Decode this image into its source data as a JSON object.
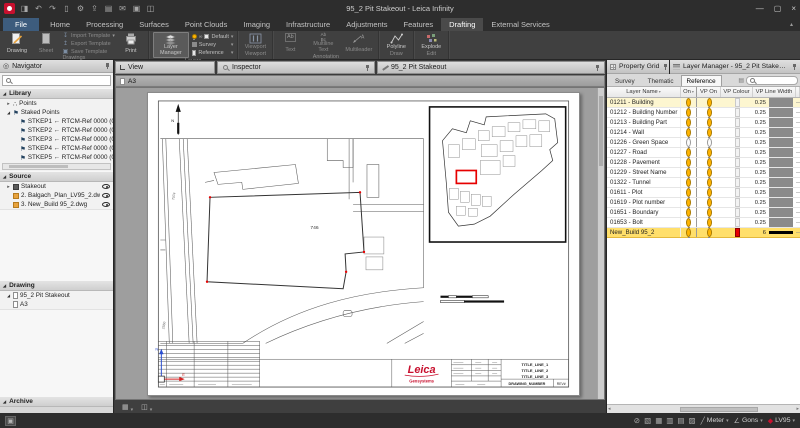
{
  "window": {
    "title": "95_2 Pit Stakeout - Leica Infinity",
    "qat": [
      {
        "name": "import-icon",
        "glyph": "◨"
      },
      {
        "name": "undo-icon",
        "glyph": "↶"
      },
      {
        "name": "redo-icon",
        "glyph": "↷"
      },
      {
        "name": "delete-icon",
        "glyph": "▯"
      },
      {
        "name": "settings-icon",
        "glyph": "⚙"
      },
      {
        "name": "export-icon",
        "glyph": "⇪"
      },
      {
        "name": "report-icon",
        "glyph": "▤"
      },
      {
        "name": "mail-icon",
        "glyph": "✉"
      },
      {
        "name": "print-icon",
        "glyph": "▣"
      },
      {
        "name": "window-icon",
        "glyph": "◫"
      }
    ],
    "controls": [
      {
        "name": "minimize-button",
        "glyph": "—"
      },
      {
        "name": "maximize-button",
        "glyph": "▢"
      },
      {
        "name": "close-button",
        "glyph": "×"
      }
    ]
  },
  "ribbon": {
    "tabs": [
      "File",
      "Home",
      "Processing",
      "Surfaces",
      "Point Clouds",
      "Imaging",
      "Infrastructure",
      "Adjustments",
      "Features",
      "Drafting",
      "External Services"
    ],
    "active_tab": "Drafting",
    "drawings": {
      "label": "Drawings",
      "drawing": "Drawing",
      "sheet": "Sheet",
      "import": "Import Template",
      "export": "Export Template",
      "save": "Save Template",
      "print": "Print"
    },
    "layers": {
      "label": "Layers",
      "layer_manager": "Layer Manager",
      "default": "Default",
      "survey": "Survey",
      "reference": "Reference"
    },
    "viewport": {
      "label": "Viewport",
      "viewport": "Viewport"
    },
    "annotation": {
      "label": "Annotation",
      "text": "Text",
      "multiline": "Multiline Text",
      "multileader": "Multileader"
    },
    "draw": {
      "label": "Draw",
      "polyline": "Polyline"
    },
    "edit": {
      "label": "Edit",
      "explode": "Explode"
    }
  },
  "navigator": {
    "title": "Navigator",
    "library": {
      "label": "Library",
      "points": "Points",
      "staked": "Staked Points",
      "staked_points": [
        "STKEP1 ← RTCM-Ref 0000 (07/10",
        "STKEP2 ← RTCM-Ref 0000 (07/10",
        "STKEP3 ← RTCM-Ref 0000 (07/10",
        "STKEP4 ← RTCM-Ref 0000 (07/10",
        "STKEP5 ← RTCM-Ref 0000 (07/10"
      ]
    },
    "source": {
      "label": "Source",
      "items": [
        "Stakeout",
        "2. Balgach_Plan_LV95_2.dwg",
        "3. New_Build 95_2.dwg"
      ]
    },
    "drawing": {
      "label": "Drawing",
      "root": "95_2 Pit Stakeout",
      "sheet": "A3"
    },
    "archive": {
      "label": "Archive"
    }
  },
  "view": {
    "tabs": [
      {
        "label": "View"
      },
      {
        "label": "Inspector"
      },
      {
        "label": "95_2 Pit Stakeout"
      }
    ],
    "doc_tab": "A3",
    "plan": {
      "building_label": "746",
      "road_label": "7074",
      "parcel_label": "2560",
      "north_label": "N",
      "axis_y_label": "N",
      "axis_x_label": "E",
      "title_block": {
        "line1": "TITLE_LINE_1",
        "line2": "TITLE_LINE_2",
        "line3": "TITLE_LINE_3",
        "drawing_number": "DRAWING_NUMBER",
        "rev": "REV#",
        "logo": "Leica",
        "logo_sub": "Geosystems"
      }
    }
  },
  "layer_manager": {
    "property_grid_title": "Property Grid",
    "title": "Layer Manager - 95_2 Pit Stakeout - A3",
    "tabs": [
      "Survey",
      "Thematic",
      "Reference"
    ],
    "active_tab": "Reference",
    "columns": [
      "Layer Name",
      "On",
      "VP On",
      "VP Colour",
      "VP Line Width"
    ],
    "selected_row_color": "#ffdf6b",
    "rows": [
      {
        "name": "01211 - Building",
        "on": true,
        "vp_on": true,
        "vp_colour": null,
        "vp_line_width": "0.25",
        "highlight": true,
        "selected": false
      },
      {
        "name": "01212 - Building Number",
        "on": true,
        "vp_on": true,
        "vp_colour": null,
        "vp_line_width": "0.25",
        "highlight": false,
        "selected": false
      },
      {
        "name": "01213 - Building Part",
        "on": true,
        "vp_on": true,
        "vp_colour": null,
        "vp_line_width": "0.25",
        "highlight": false,
        "selected": false
      },
      {
        "name": "01214 - Wall",
        "on": true,
        "vp_on": true,
        "vp_colour": null,
        "vp_line_width": "0.25",
        "highlight": false,
        "selected": false
      },
      {
        "name": "01226 - Green Space",
        "on": false,
        "vp_on": false,
        "vp_colour": null,
        "vp_line_width": "0.25",
        "highlight": false,
        "selected": false
      },
      {
        "name": "01227 - Road",
        "on": true,
        "vp_on": true,
        "vp_colour": null,
        "vp_line_width": "0.25",
        "highlight": false,
        "selected": false
      },
      {
        "name": "01228 - Pavement",
        "on": true,
        "vp_on": true,
        "vp_colour": null,
        "vp_line_width": "0.25",
        "highlight": false,
        "selected": false
      },
      {
        "name": "01229 - Street Name",
        "on": true,
        "vp_on": true,
        "vp_colour": null,
        "vp_line_width": "0.25",
        "highlight": false,
        "selected": false
      },
      {
        "name": "01322 - Tunnel",
        "on": true,
        "vp_on": true,
        "vp_colour": null,
        "vp_line_width": "0.25",
        "highlight": false,
        "selected": false
      },
      {
        "name": "01611 - Plot",
        "on": true,
        "vp_on": true,
        "vp_colour": null,
        "vp_line_width": "0.25",
        "highlight": false,
        "selected": false
      },
      {
        "name": "01619 - Plot number",
        "on": true,
        "vp_on": true,
        "vp_colour": null,
        "vp_line_width": "0.25",
        "highlight": false,
        "selected": false
      },
      {
        "name": "01651 - Boundary",
        "on": true,
        "vp_on": true,
        "vp_colour": null,
        "vp_line_width": "0.25",
        "highlight": false,
        "selected": false
      },
      {
        "name": "01653 - Bolt",
        "on": true,
        "vp_on": true,
        "vp_colour": null,
        "vp_line_width": "0.25",
        "highlight": false,
        "selected": false
      },
      {
        "name": "New_Build 95_2",
        "on": true,
        "vp_on": true,
        "vp_colour": "#e60000",
        "vp_line_width": "6",
        "highlight": false,
        "selected": true
      }
    ]
  },
  "status_bar": {
    "expand_glyph": "▣",
    "icons": [
      {
        "name": "snap-off-icon",
        "glyph": "⊘"
      },
      {
        "name": "image-toggle-icon",
        "glyph": "▧"
      },
      {
        "name": "grid-toggle-icon",
        "glyph": "▦"
      },
      {
        "name": "hatch-toggle-icon",
        "glyph": "▥"
      },
      {
        "name": "table-toggle-icon",
        "glyph": "▤"
      },
      {
        "name": "folder-icon",
        "glyph": "▨"
      }
    ],
    "distance_icon": "╱",
    "distance_unit": "Meter",
    "angle_icon": "∠",
    "angle_unit": "Gons",
    "crs_icon": "◆",
    "crs": "LV95"
  }
}
